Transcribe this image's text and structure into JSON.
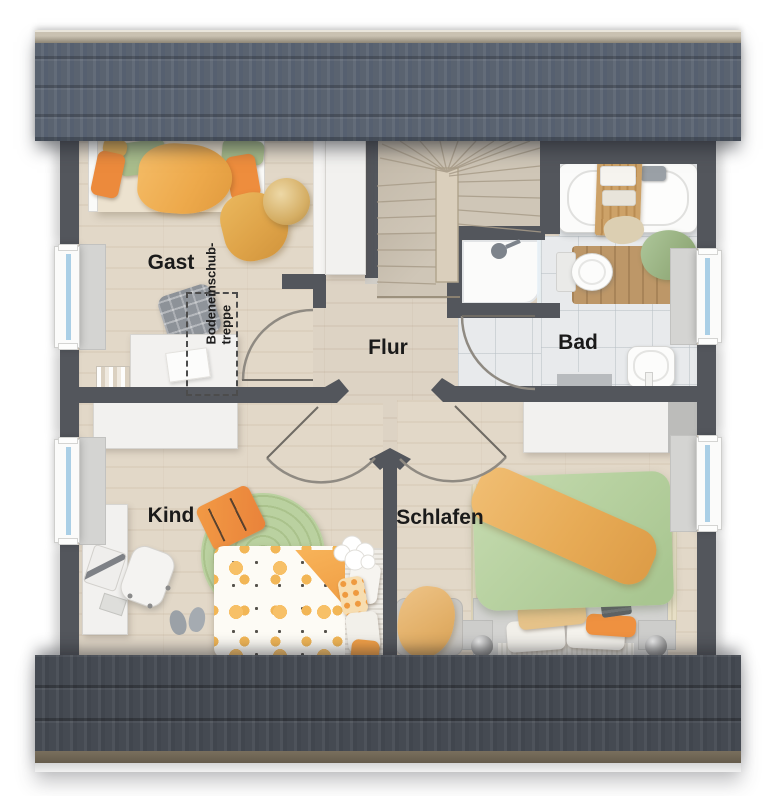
{
  "floorplan": {
    "rooms": [
      {
        "id": "gast",
        "label": "Gast"
      },
      {
        "id": "flur",
        "label": "Flur"
      },
      {
        "id": "bad",
        "label": "Bad"
      },
      {
        "id": "kind",
        "label": "Kind"
      },
      {
        "id": "schlafen",
        "label": "Schlafen"
      }
    ],
    "attic_hatch_label": {
      "line1": "Bodeneinschub-",
      "line2": "treppe"
    },
    "colors": {
      "wall": "#53565c",
      "roof_top": "#5b6470",
      "roof_ridge": "#a59c8a",
      "roof_bottom": "#44494f",
      "floor_wood": "#e1d7c7",
      "floor_hall": "#dcd2c3",
      "floor_tile": "#e8eaec",
      "stair_wood": "#cfc6b7",
      "window_glass": "#aacfe6",
      "accent_orange": "#ee8d3f",
      "accent_green": "#aec794",
      "accent_mustard": "#e6ae55"
    }
  }
}
